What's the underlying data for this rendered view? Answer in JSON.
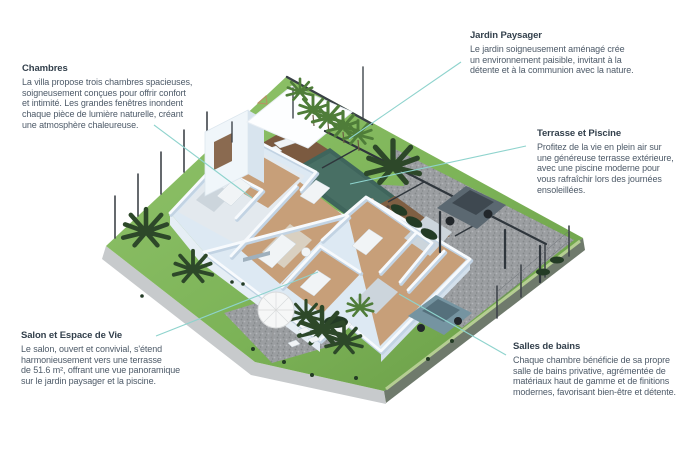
{
  "page": {
    "kind": "villa floor-plan infographic"
  },
  "colors": {
    "background": "#ffffff",
    "title_text": "#33404c",
    "body_text": "#4d5a68",
    "leader_line": "#8ed3cd",
    "lawn": "#7cb357",
    "lawn_light": "#92c46c",
    "lawn_dark": "#689a45",
    "plot_side": "#6f7a6c",
    "plot_rim": "#c7cacc",
    "edge_strip": "#b5ce92",
    "gravel": "#9b9ea1",
    "gravel_dark": "#84878a",
    "gravel_light": "#b2b5b8",
    "pool": "#3f655c",
    "pool_light": "#4d7568",
    "deck": "#7b5a40",
    "terrace": "#7f5f43",
    "wall": "#f7fafd",
    "wall_shadow": "#c2d3e3",
    "wall_face": "#dde9f3",
    "floor_wood": "#c79f79",
    "floor_tile": "#ccd5dc",
    "rug": "#d9d0c1",
    "furniture": "#f1f4f6",
    "pergola": "#2f363c",
    "fence": "#3f444a",
    "suv": "#5b6871",
    "suv_dark": "#3e4850",
    "car": "#7594a1",
    "car_dark": "#55707c",
    "wheel": "#22272b",
    "palm_dark": "#2d4829",
    "palm_light": "#4f7d39",
    "bush": "#233b25",
    "umbrella": "#f6f7f7",
    "umbrella_edge": "#d9dbdc"
  },
  "scene": {
    "type": "isometric-3d-cutaway-floor-plan",
    "features": [
      "garden lawn",
      "swimming pool",
      "wood deck with loungers",
      "covered terrace with pergola",
      "gravel driveway",
      "two parked cars",
      "palm trees",
      "parasol patio",
      "perimeter fence",
      "cutaway villa interior"
    ]
  },
  "callouts": [
    {
      "id": "chambres",
      "title": "Chambres",
      "body": "La villa propose trois chambres spacieuses,\nsoigneusement conçues pour offrir confort\net intimité. Les grandes fenêtres inondent\nchaque pièce de lumière naturelle, créant\nune atmosphère chaleureuse."
    },
    {
      "id": "jardin-paysager",
      "title": "Jardin Paysager",
      "body": "Le jardin soigneusement aménagé crée\nun environnement paisible, invitant à la\ndétente et à la communion avec la nature."
    },
    {
      "id": "terrasse-et-piscine",
      "title": "Terrasse et Piscine",
      "body": "Profitez de la vie en plein air sur\nune généreuse terrasse extérieure,\navec une piscine moderne pour\nvous rafraîchir lors des journées\nensoleillées."
    },
    {
      "id": "salon-et-espace-de-vie",
      "title": "Salon et Espace de Vie",
      "body": "Le salon, ouvert et convivial, s'étend\nharmonieusement vers une terrasse\nde 51.6 m², offrant une vue panoramique\nsur le jardin paysager et la piscine."
    },
    {
      "id": "salles-de-bains",
      "title": "Salles de bains",
      "body": "Chaque chambre bénéficie de sa propre\nsalle de bains privative, agrémentée de\nmatériaux haut de gamme et de finitions\nmodernes, favorisant bien-être et détente."
    }
  ]
}
